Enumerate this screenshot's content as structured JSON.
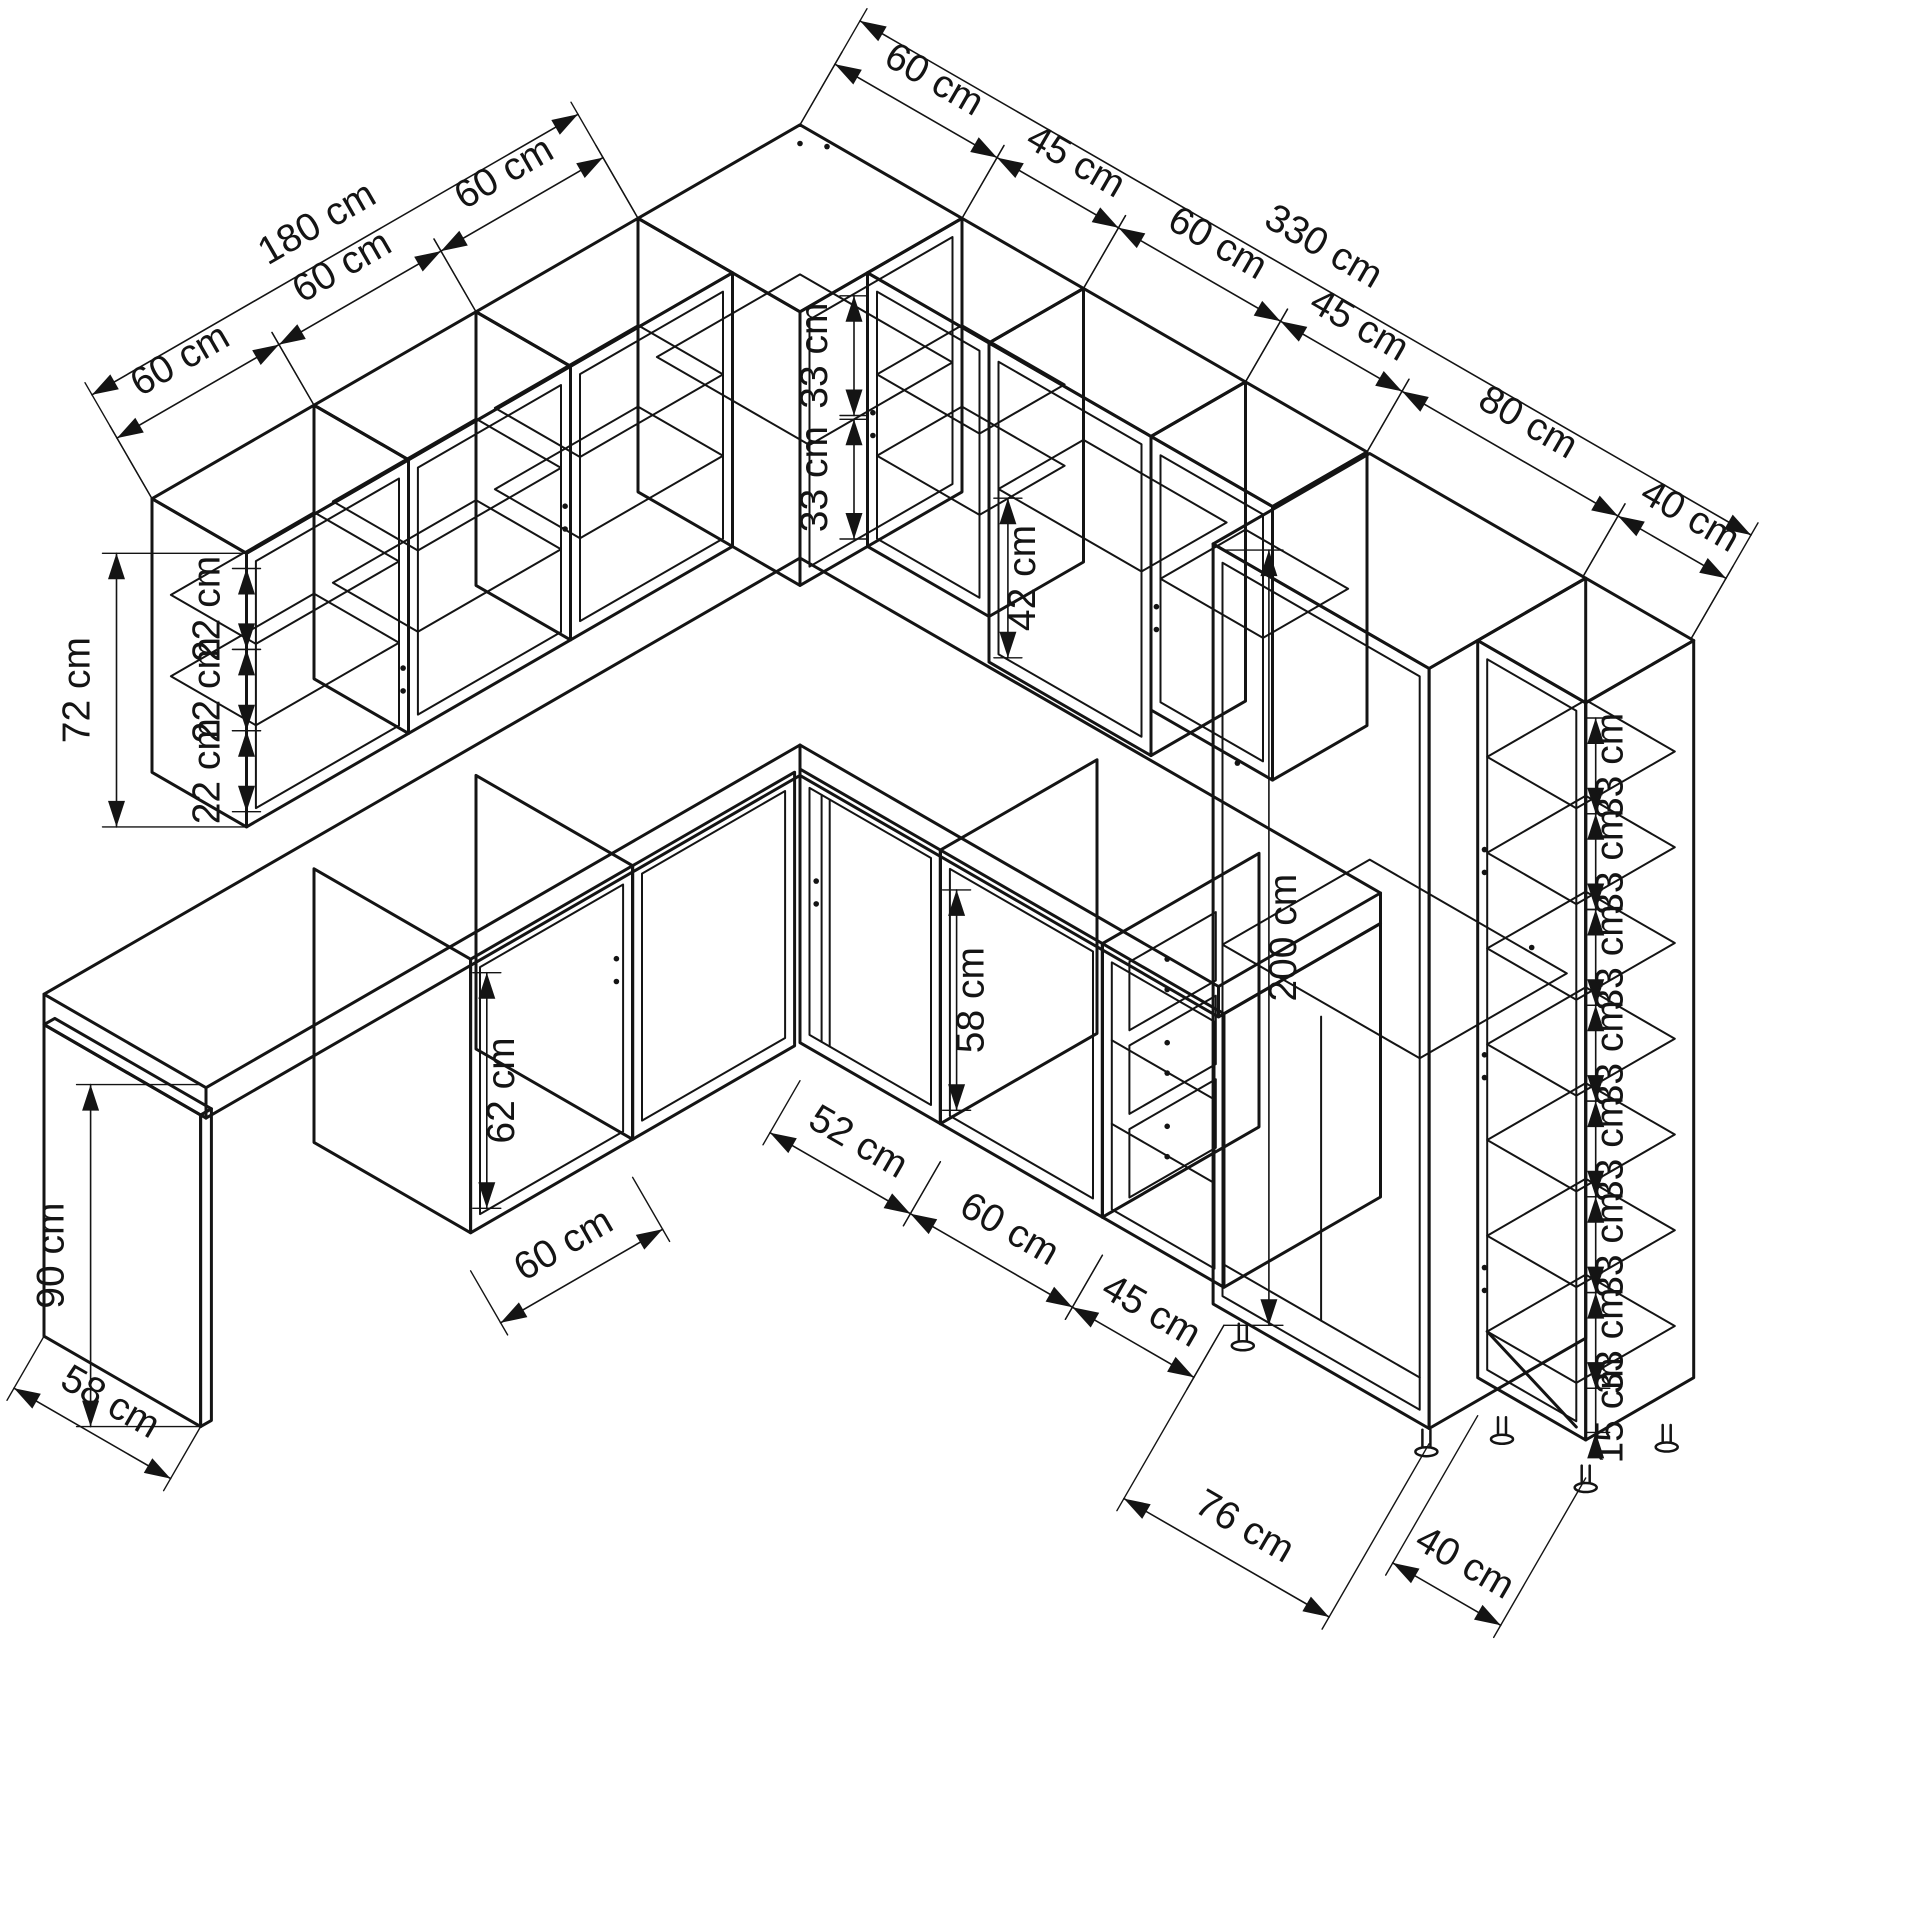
{
  "drawing": {
    "kind": "isometric-kitchen-cabinet-dimension-diagram",
    "ink_color": "#141414",
    "background_color": "#ffffff"
  },
  "labels": {
    "left_total": "180 cm",
    "left_segments": [
      "60 cm",
      "60 cm",
      "60 cm"
    ],
    "right_total": "330 cm",
    "right_segments": [
      "60 cm",
      "45 cm",
      "60 cm",
      "45 cm",
      "80 cm",
      "40 cm"
    ],
    "wall_height": "72 cm",
    "wall_gaps": [
      "22 cm",
      "22 cm",
      "22 cm"
    ],
    "corner_gaps": [
      "33 cm",
      "33 cm"
    ],
    "right_wall_gap": "42 cm",
    "counter_height": "90 cm",
    "left_floor_depth": "58 cm",
    "left_base_width": "60 cm",
    "left_base_interior": "62 cm",
    "base_widths": [
      "52 cm",
      "60 cm",
      "45 cm"
    ],
    "base_interior": "58 cm",
    "tall_height": "200 cm",
    "tall_floor_width": "76 cm",
    "shelf_floor_width": "40 cm",
    "shelf_gaps": [
      "33 cm",
      "33 cm",
      "33 cm",
      "33 cm",
      "33 cm",
      "33 cm",
      "33 cm"
    ],
    "shelf_bottom_gap": "15 cm"
  }
}
